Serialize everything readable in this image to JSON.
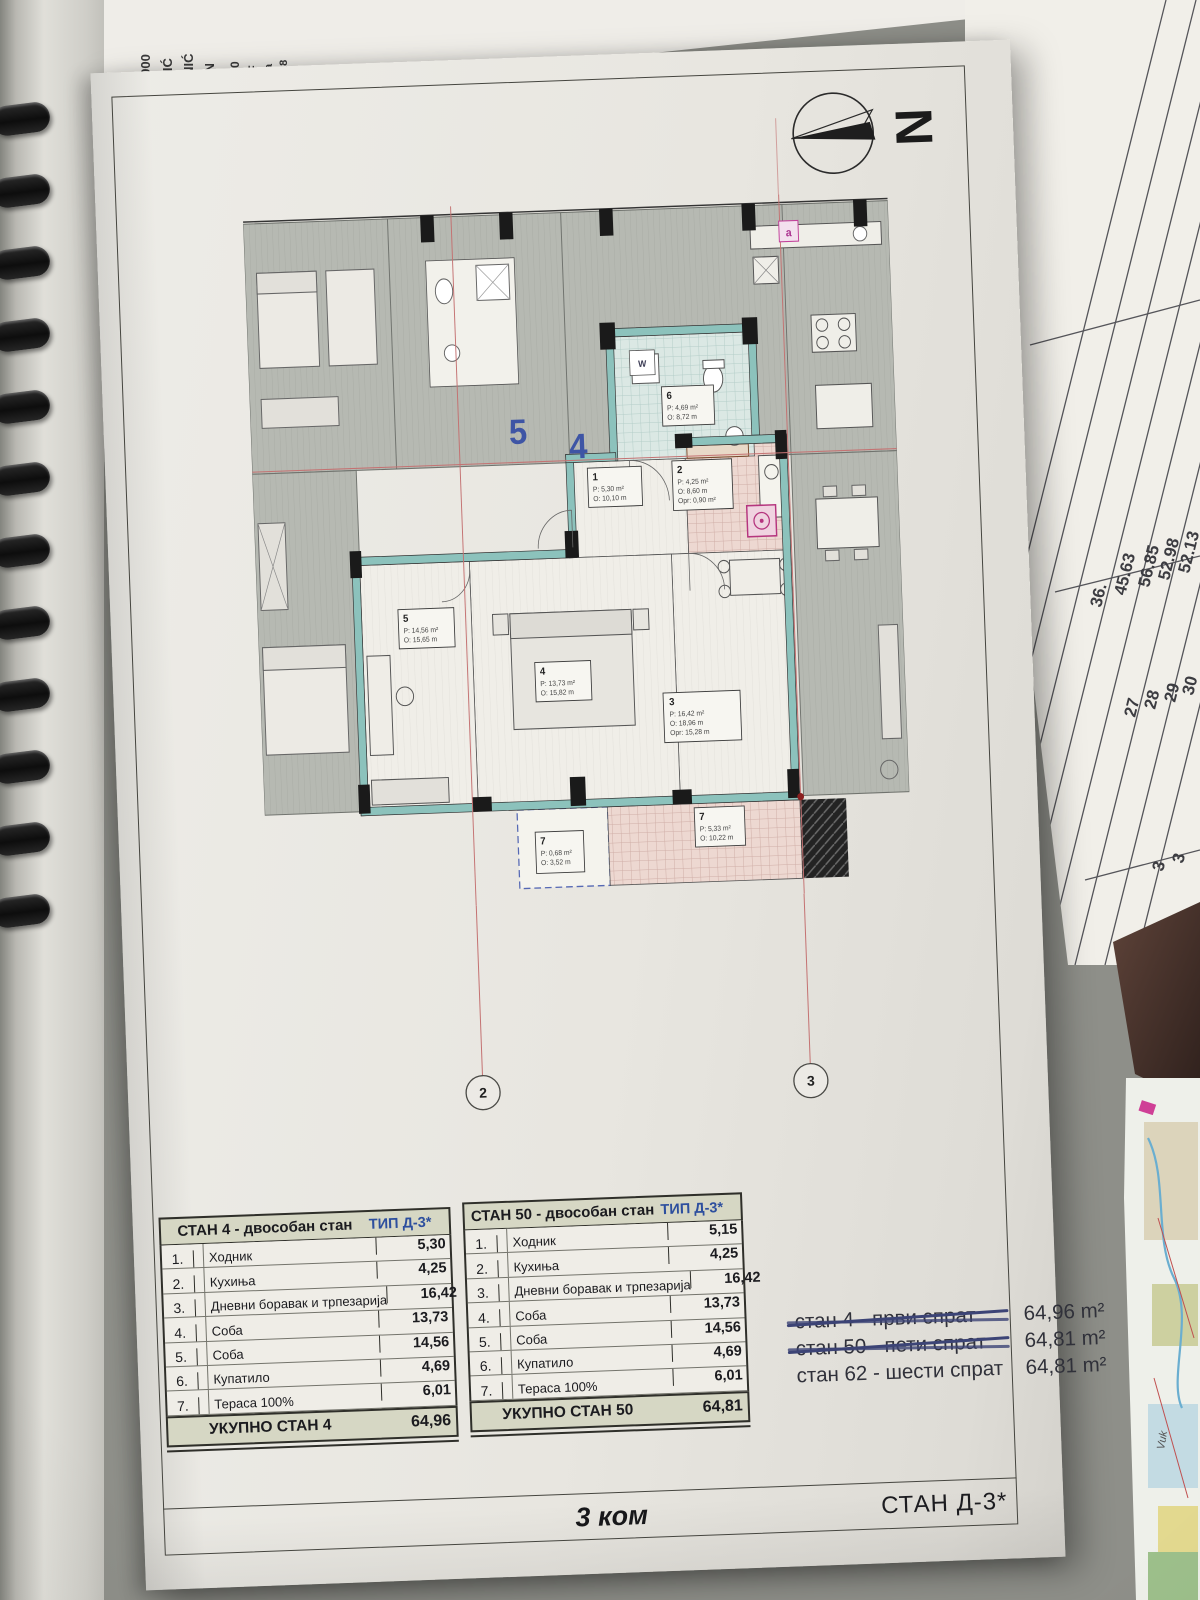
{
  "document": {
    "north_label": "N",
    "axes": {
      "left": "2",
      "right": "3"
    },
    "footer": {
      "count": "3 ком",
      "sheet": "СТАН Д-3*"
    }
  },
  "floor_plan": {
    "unit_marks": {
      "left": "5",
      "right": "4",
      "corner": "a",
      "washer": "W"
    },
    "labels": {
      "l1": {
        "id": "1",
        "p": "P: 5,30 m²",
        "o": "O: 10,10 m"
      },
      "l2": {
        "id": "2",
        "p": "P: 4,25 m²",
        "o": "O: 8,60 m",
        "x": "Opr: 0,90 m²"
      },
      "l3": {
        "id": "3",
        "p": "P: 16,42 m²",
        "o": "O: 18,96 m",
        "x": "Opr: 15,28 m"
      },
      "l4": {
        "id": "4",
        "p": "P: 13,73 m²",
        "o": "O: 15,82 m"
      },
      "l5": {
        "id": "5",
        "p": "P: 14,56 m²",
        "o": "O: 15,65 m"
      },
      "l6": {
        "id": "6",
        "p": "P: 4,69 m²",
        "o": "O: 8,72 m"
      },
      "l7a": {
        "id": "7",
        "p": "P: 0,68 m²",
        "o": "O: 3,52 m"
      },
      "l7b": {
        "id": "7",
        "p": "P: 5,33 m²",
        "o": "O: 10,22 m"
      }
    }
  },
  "tables": [
    {
      "title": "СТАН 4 - двособан стан",
      "type": "ТИП Д-3*",
      "rows": [
        [
          "1.",
          "Ходник",
          "5,30"
        ],
        [
          "2.",
          "Кухиња",
          "4,25"
        ],
        [
          "3.",
          "Дневни боравак и трпезарија",
          "16,42"
        ],
        [
          "4.",
          "Соба",
          "13,73"
        ],
        [
          "5.",
          "Соба",
          "14,56"
        ],
        [
          "6.",
          "Купатило",
          "4,69"
        ],
        [
          "7.",
          "Тераса 100%",
          "6,01"
        ]
      ],
      "total_label": "УКУПНО СТАН 4",
      "total_value": "64,96"
    },
    {
      "title": "СТАН 50 - двособан стан",
      "type": "ТИП Д-3*",
      "rows": [
        [
          "1.",
          "Ходник",
          "5,15"
        ],
        [
          "2.",
          "Кухиња",
          "4,25"
        ],
        [
          "3.",
          "Дневни боравак и трпезарија",
          "16,42"
        ],
        [
          "4.",
          "Соба",
          "13,73"
        ],
        [
          "5.",
          "Соба",
          "14,56"
        ],
        [
          "6.",
          "Купатило",
          "4,69"
        ],
        [
          "7.",
          "Тераса 100%",
          "6,01"
        ]
      ],
      "total_label": "УКУПНО СТАН 50",
      "total_value": "64,81"
    }
  ],
  "summary": {
    "rows": [
      {
        "label": "стан 4 - први спрат",
        "value": "64,96 m²",
        "struck": true
      },
      {
        "label": "стан 50 - пети спрат",
        "value": "64,81 m²",
        "struck": true
      },
      {
        "label": "стан 62 - шести спрат",
        "value": "64,81 m²",
        "struck": false
      }
    ]
  },
  "background": {
    "left_fragments": [
      "IC GROU",
      "KA RADIĆ",
      "RAGUJEV",
      "00000000",
      "ŠKOVIĆ",
      "ROVNIĆ",
      "EČAN",
      "0800",
      "ISF",
      "(ra",
      "18"
    ],
    "top_fragments": [
      "1310310000",
      "koje su n",
      "the creati"
    ],
    "right_table": {
      "values": [
        "36.",
        "45.63",
        "56.85",
        "52.98",
        "52.13"
      ],
      "rows": [
        "27",
        "28",
        "29",
        "30"
      ],
      "extras": [
        "3",
        "3"
      ]
    },
    "map_label": "Vuk"
  }
}
